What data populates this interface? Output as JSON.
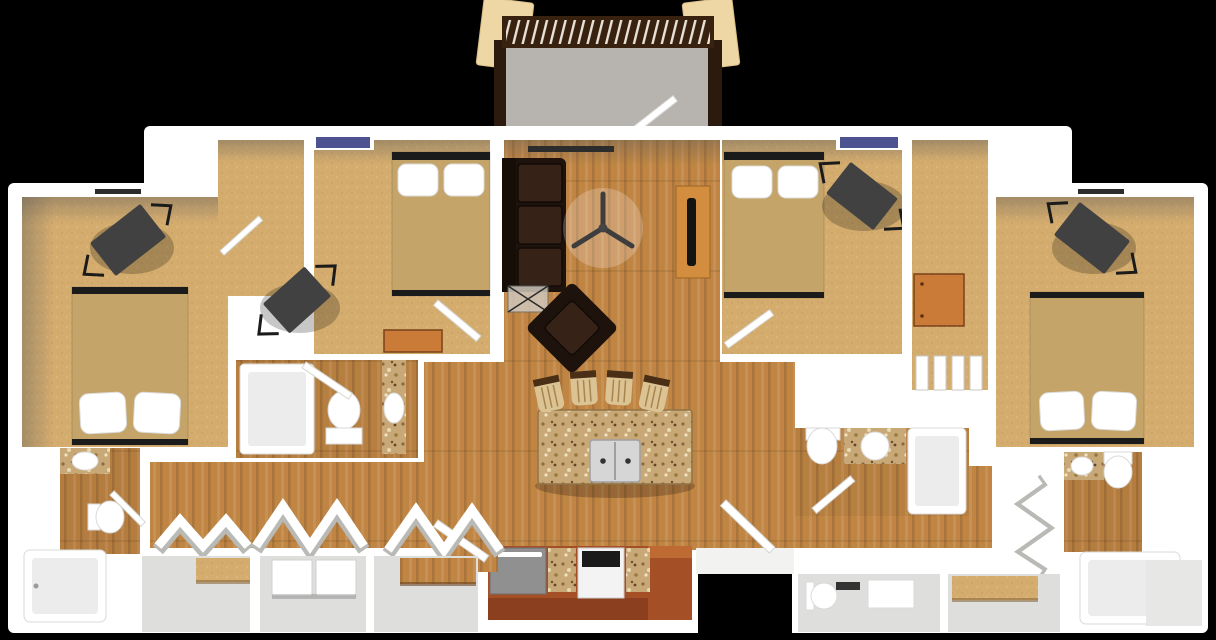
{
  "image": {
    "description": "3D rendered top-down floor plan of a four-bedroom, four-bathroom apartment on a black background",
    "width": 1216,
    "height": 640
  },
  "colors": {
    "background": "#000000",
    "wall": "#ffffff",
    "carpet": "#d4ac6e",
    "wood": "#c08543",
    "blanket": "#c4a469",
    "bed_frame": "#1b1b1b",
    "pillow": "#ffffff",
    "sofa": "#1d120c",
    "sofa_cushion": "#372217",
    "console": "#d28d3e",
    "tv": "#141414",
    "granite": "#c9a878",
    "cherry": "#a54f27",
    "cherry_dark": "#8c3f1e",
    "stool": "#dcc394",
    "appliance_gray": "#909090",
    "stove_white": "#f3f3f3",
    "stove_top": "#1a1a1a",
    "concrete": "#b7b3af",
    "railing": "#38220f",
    "column": "#eed7a4",
    "window_glass": "#4d5290",
    "desk": "#414141",
    "chair_wire": "#1b1b1b",
    "dresser": "#c97b37",
    "floor_gray": "#dededd"
  },
  "regions": {
    "balcony": {
      "elements": [
        "column-left",
        "column-right",
        "railing-with-balusters",
        "side-rails",
        "concrete-floor",
        "balcony-door"
      ]
    },
    "living_room": {
      "furniture": [
        "leather-sofa",
        "leather-armchair",
        "glass-coffee-table",
        "ceiling-fan",
        "tv-console",
        "tv"
      ]
    },
    "kitchen": {
      "furniture": [
        "granite-island",
        "double-sink",
        "bar-stools-x4",
        "dishwasher",
        "stove",
        "granite-counters",
        "cherry-cabinets",
        "pantry-door"
      ]
    },
    "bedrooms": [
      {
        "id": "bedroom-far-left",
        "furniture": [
          "bed",
          "desk",
          "wire-desk-chair"
        ]
      },
      {
        "id": "bedroom-upper-left",
        "furniture": [
          "bed",
          "window",
          "desk",
          "wire-desk-chair",
          "dresser",
          "walk-in-closet"
        ]
      },
      {
        "id": "bedroom-upper-right",
        "furniture": [
          "bed",
          "window",
          "desk",
          "wire-desk-chair",
          "dresser",
          "louver-closet"
        ]
      },
      {
        "id": "bedroom-far-right",
        "furniture": [
          "bed",
          "desk",
          "wire-desk-chair"
        ]
      }
    ],
    "bathrooms": [
      {
        "id": "bathroom-far-left",
        "fixtures": [
          "granite-vanity-sink",
          "toilet",
          "bathtub"
        ]
      },
      {
        "id": "bathroom-center-left",
        "fixtures": [
          "bathtub",
          "toilet",
          "granite-vanity-sink"
        ]
      },
      {
        "id": "bathroom-center-right",
        "fixtures": [
          "toilet",
          "granite-vanity-sink",
          "bathtub"
        ]
      },
      {
        "id": "bathroom-far-right",
        "fixtures": [
          "granite-vanity-sink",
          "toilet",
          "bathtub"
        ]
      }
    ],
    "hallways": {
      "features": [
        "bifold-closet-doors",
        "laundry-closet",
        "linen-closets",
        "entry-door"
      ]
    }
  }
}
